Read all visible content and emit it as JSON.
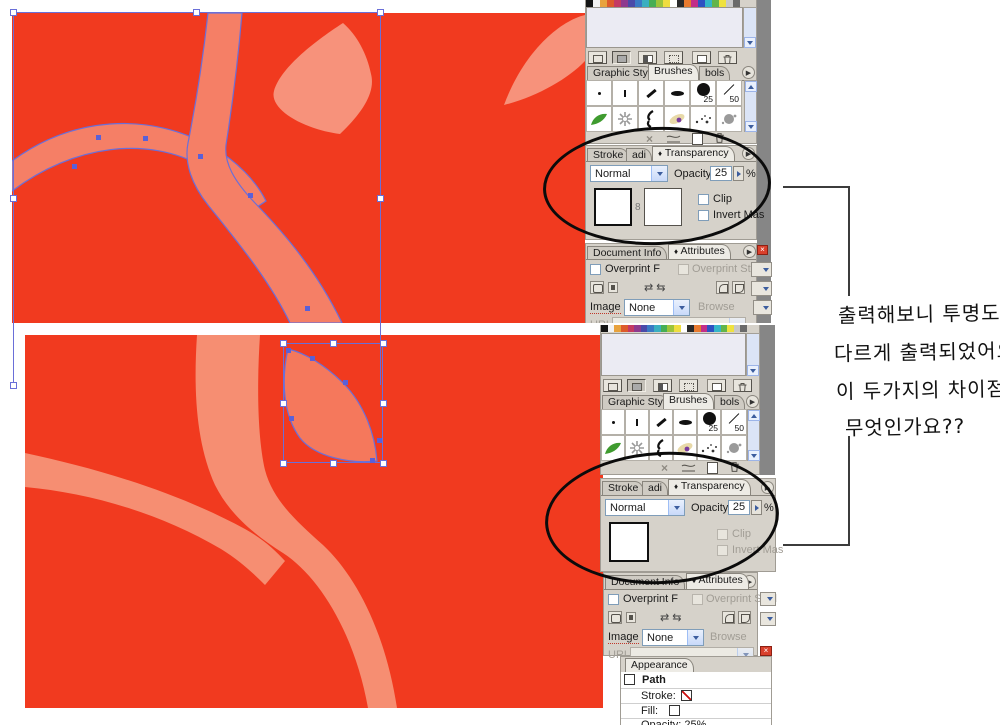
{
  "artwork": {
    "colors": {
      "background": "#f13a1f",
      "branch_top": "#f57f66",
      "leaf_light": "#f7927b",
      "branch_bottom": "#f68e72",
      "leaf_selected": "#f5785c",
      "selection_blue": "#6a6fd8"
    }
  },
  "swatches": {
    "colors": [
      "#141414",
      "#f2f2f2",
      "#e8a23c",
      "#dd5a2a",
      "#c43a63",
      "#8e3a8e",
      "#4a4aa8",
      "#3a7ac4",
      "#3aafc0",
      "#46ae54",
      "#9cc43a",
      "#efdd3f",
      "#ffffff",
      "#2a2a2a",
      "#e87a2e",
      "#c22e88",
      "#2e52c2",
      "#35b6c8",
      "#62b54a",
      "#efe23f",
      "#c8c8c8",
      "#6a6a6a"
    ]
  },
  "icons": {
    "flyout": "▶",
    "collapse": "♦",
    "swap1": "⇄",
    "swap2": "⇆",
    "link": "8",
    "close_x": "×",
    "delete_x": "×"
  },
  "brushes_panel": {
    "tabs": [
      {
        "label": "Graphic Sty"
      },
      {
        "label": "Brushes"
      },
      {
        "label": "bols"
      }
    ],
    "brush_labels": {
      "b25": "25",
      "b50": "50"
    }
  },
  "transparency_panel": {
    "tabs": [
      {
        "label": "Stroke"
      },
      {
        "label": "adi"
      },
      {
        "label": "Transparency"
      }
    ],
    "blend_mode": "Normal",
    "opacity_label": "Opacity",
    "opacity_value": "25",
    "percent": "%",
    "clip_label": "Clip",
    "invert_label": "Invert Mas"
  },
  "attributes_panel": {
    "tabs": [
      {
        "label": "Document Info"
      },
      {
        "label": "Attributes"
      }
    ],
    "overprint_fill": "Overprint F",
    "overprint_stroke": "Overprint Strol",
    "image_label": "Image",
    "image_value": "None",
    "browse_label": "Browse",
    "url_label": "URL"
  },
  "appearance_panel": {
    "tab": "Appearance",
    "item": "Path",
    "stroke_label": "Stroke:",
    "fill_label": "Fill:",
    "opacity_label": "Opacity: 25%"
  },
  "annotation": {
    "lines": [
      "출력해보니 투명도가",
      "다르게 출력되었어요..",
      "이 두가지의 차이점이",
      "무엇인가요??"
    ]
  }
}
